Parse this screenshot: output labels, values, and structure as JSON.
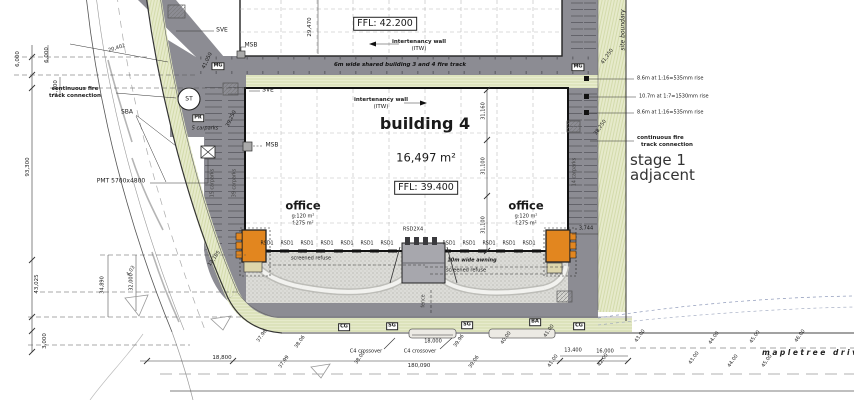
{
  "drawing": {
    "building3": {
      "ffl": "FFL: 42.200"
    },
    "building4": {
      "name": "building 4",
      "area": "16,497 m²",
      "ffl": "FFL: 39.400"
    },
    "office": {
      "title": "office",
      "gross": "g:120 m²",
      "floor": "f:275 m²"
    },
    "labels": {
      "fire_track": "6m wide shared building 3 and 4 fire track",
      "itw": "intertenancy wall",
      "itw_abbr": "(ITW)",
      "continuous_fire_1": "continuous fire",
      "continuous_fire_2": "track connection",
      "site_boundary": "site boundary",
      "stage1_1": "stage 1",
      "stage1_2": "adjacent",
      "ramp_a": "8.6m at 1:16=535mm rise",
      "ramp_b": "10.7m at 1:7=1530mm rise",
      "ramp_c": "8.6m at 1:16=535mm rise",
      "pmt": "PMT 5700x4800",
      "screened_refuse": "screened refuse",
      "awning": "10m wide awning",
      "mapletree": "mapletree drive",
      "crossover": "C4 crossover",
      "fence": "fence",
      "carparks_5": "5 carparks",
      "carparks_14": "14 carparks",
      "carparks_15": "15 carparks",
      "carparks_39": "39 carparks",
      "sve": "SVE",
      "msb": "MSB",
      "mg": "MG",
      "st": "ST",
      "pr": "PR",
      "sba": "SBA",
      "cg": "CG",
      "sg": "SG",
      "ba": "BA",
      "rsd1": "RSD1",
      "rsd2x4": "RSD2X4"
    },
    "dimensions": {
      "d29470": "29,470",
      "d20402": "20,402",
      "d6000": "6,000",
      "d1100": "1,100",
      "d93300": "93,300",
      "d43025": "43,025",
      "d34890": "34,890",
      "d32000": "32,000",
      "d3000": "3,000",
      "d41050": "41,050",
      "d41250": "41,250",
      "d39250": "39,250",
      "d38250": "38,250",
      "d12105": "12,105",
      "d31160": "31,160",
      "d31100": "31,100",
      "d3744": "3,744",
      "d18800": "18,800",
      "d180090": "180,090",
      "d18000": "18,000",
      "d13400": "13,400",
      "d16000": "16,000"
    },
    "spot_levels": [
      "37.96",
      "38.06",
      "37.99",
      "38.00",
      "39.96",
      "40.00",
      "41.00",
      "39.06",
      "41.00",
      "42.00",
      "43.00",
      "43.00",
      "44.00",
      "44.00",
      "45.00",
      "45.00",
      "46.00",
      "4.03"
    ],
    "colors": {
      "office_orange": "#e2861f",
      "landscape_green": "#e6eacb",
      "road_gray": "#8c8c93",
      "yard_gray": "#dcdcd8"
    }
  }
}
